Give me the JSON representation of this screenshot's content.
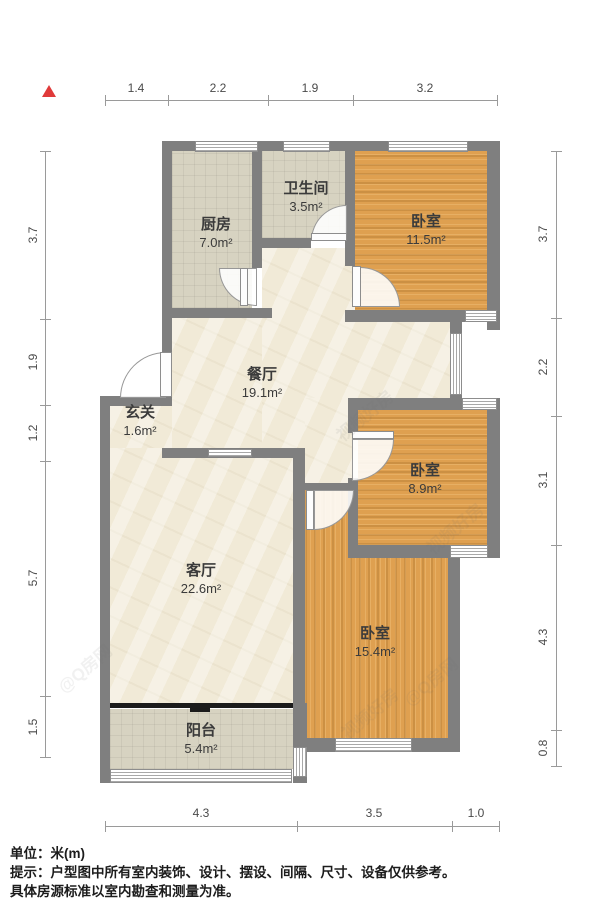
{
  "compass": {
    "label": "north-arrow"
  },
  "dimensions": {
    "unit_note": "米(m)",
    "top": [
      "1.4",
      "2.2",
      "1.9",
      "3.2"
    ],
    "left": [
      "3.7",
      "1.9",
      "1.2",
      "5.7",
      "1.5"
    ],
    "right": [
      "3.7",
      "2.2",
      "3.1",
      "4.3",
      "0.8"
    ],
    "bottom": [
      "4.3",
      "3.5",
      "1.0"
    ]
  },
  "rooms": {
    "kitchen": {
      "name": "厨房",
      "area": "7.0m²"
    },
    "bathroom": {
      "name": "卫生间",
      "area": "3.5m²"
    },
    "bedroom_top": {
      "name": "卧室",
      "area": "11.5m²"
    },
    "dining": {
      "name": "餐厅",
      "area": "19.1m²"
    },
    "entry": {
      "name": "玄关",
      "area": "1.6m²"
    },
    "bedroom_mid": {
      "name": "卧室",
      "area": "8.9m²"
    },
    "living": {
      "name": "客厅",
      "area": "22.6m²"
    },
    "bedroom_bottom": {
      "name": "卧室",
      "area": "15.4m²"
    },
    "balcony": {
      "name": "阳台",
      "area": "5.4m²"
    }
  },
  "footer": {
    "unit_label": "单位：米(m)",
    "tip_line1": "提示：户型图中所有室内装饰、设计、摆设、间隔、尺寸、设备仅供参考。",
    "tip_line2": "具体房源标准以室内勘查和测量为准。"
  },
  "watermarks": {
    "wm1": "@Q房网",
    "wm2": "视频好房",
    "wm3": "@Q房网",
    "wm4": "视频好房",
    "wm5": "视频好房"
  },
  "colors": {
    "wall": "#7f7f7f",
    "wood_floor": "#dfa050",
    "tile_floor": "#d7d3c1",
    "cream_floor": "#f1ead7",
    "compass_red": "#e03a3a"
  }
}
